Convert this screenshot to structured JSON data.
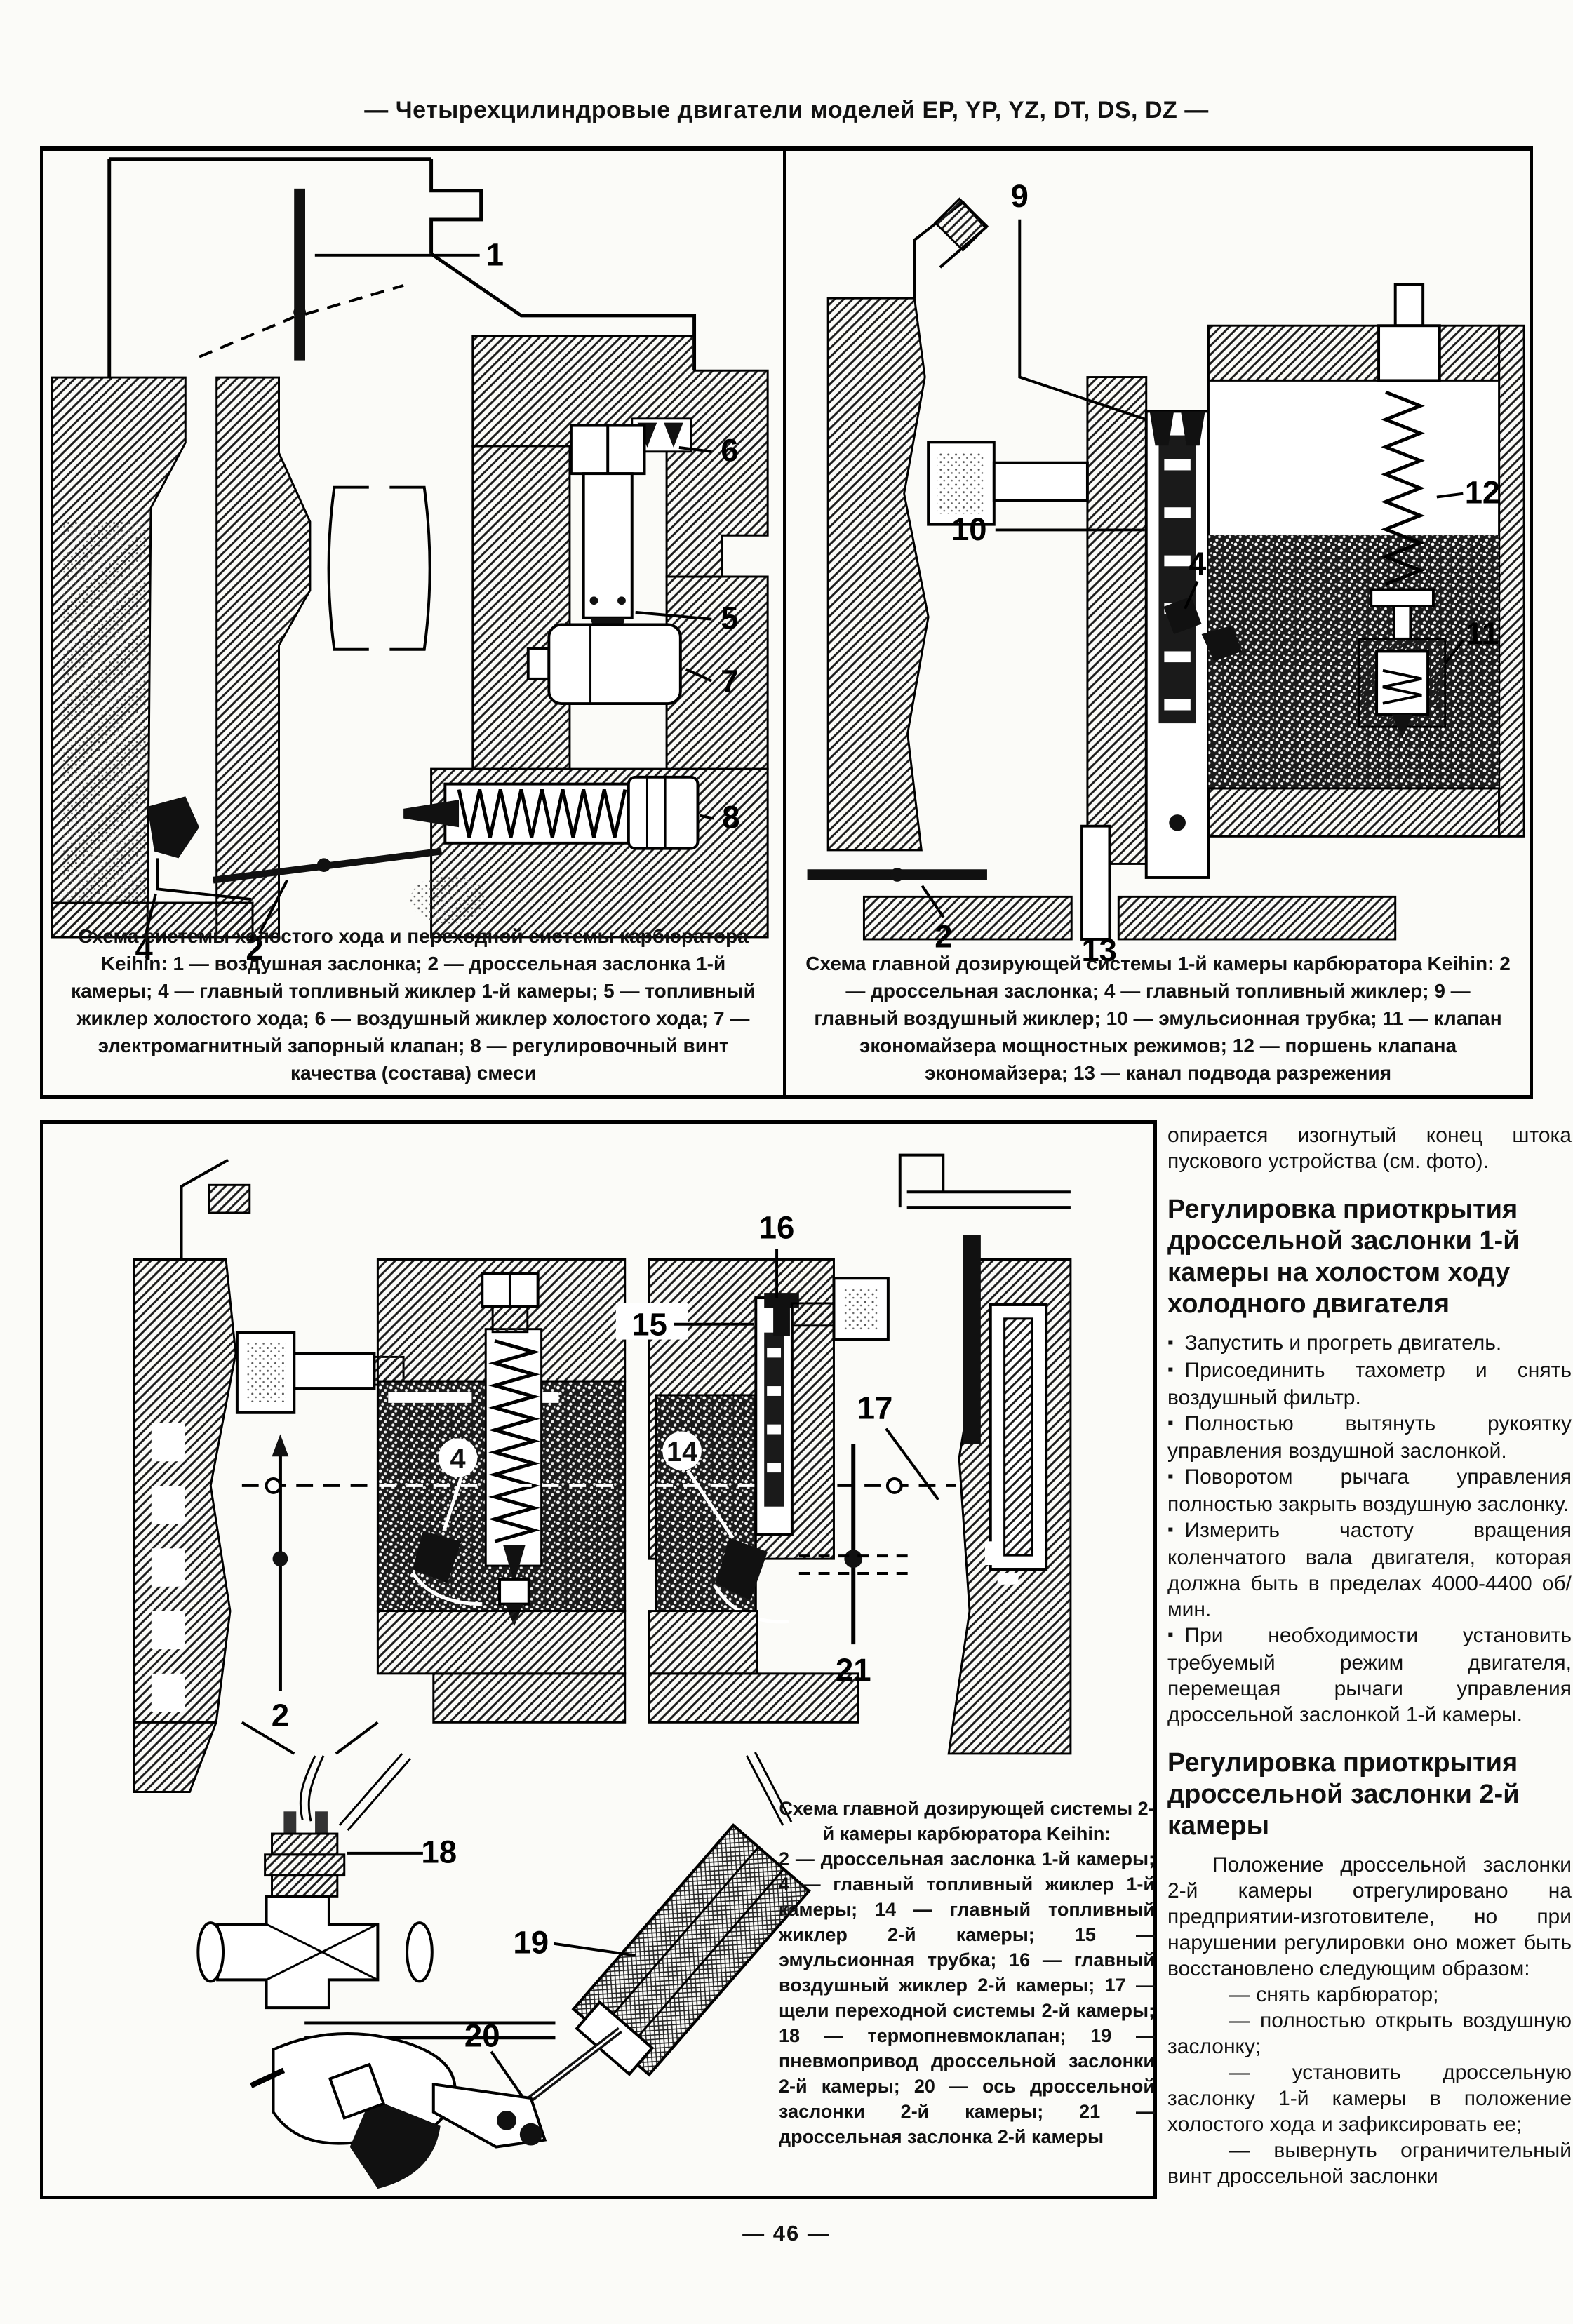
{
  "page": {
    "header": "— Четырехцилиндровые двигатели моделей EP, YP, YZ, DT, DS, DZ —",
    "page_number": "— 46 —"
  },
  "figure1": {
    "caption_title": "Схема системы холостого хода и переходной системы карбюратора Keihin:",
    "caption_items": "1 — воздушная заслонка; 2 — дроссельная заслонка 1-й камеры; 4 — главный топливный жиклер 1-й камеры; 5 — топливный жиклер холостого хода; 6 — воздушный жиклер холостого хода; 7 — электромагнитный запорный клапан; 8 — регулировочный винт качества (состава) смеси",
    "callouts": {
      "c1": "1",
      "c2": "2",
      "c4": "4",
      "c5": "5",
      "c6": "6",
      "c7": "7",
      "c8": "8"
    }
  },
  "figure2": {
    "caption_title": "Схема главной дозирующей системы 1-й камеры карбюратора Keihin:",
    "caption_items": "2 — дроссельная заслонка; 4 — главный топливный жиклер; 9 — главный воздушный жиклер; 10 — эмульсионная трубка; 11 — клапан экономайзера мощностных режимов; 12 — поршень клапана экономайзера; 13 — канал подвода разрежения",
    "callouts": {
      "c2": "2",
      "c4": "4",
      "c9": "9",
      "c10": "10",
      "c11": "11",
      "c12": "12",
      "c13": "13"
    }
  },
  "figure3": {
    "caption_title": "Схема главной дозирующей системы 2-й камеры карбюратора Keihin:",
    "caption_items": "2 — дроссельная заслонка 1-й камеры; 4 — главный топливный жиклер 1-й камеры; 14 — главный топливный жиклер 2-й камеры; 15 — эмульсионная трубка; 16 — главный воздушный жиклер 2-й камеры; 17 — щели переходной системы 2-й камеры; 18 — термопневмоклапан; 19 — пневмопривод дроссельной заслонки 2-й камеры; 20 — ось дроссельной заслонки 2-й камеры; 21 — дроссельная заслонка 2-й камеры",
    "callouts": {
      "c2": "2",
      "c4": "4",
      "c14": "14",
      "c15": "15",
      "c16": "16",
      "c17": "17",
      "c18": "18",
      "c19": "19",
      "c20": "20",
      "c21": "21"
    }
  },
  "column": {
    "intro": "опирается изогнутый конец штока пускового устройства (см. фото).",
    "section1": {
      "heading": "Регулировка приоткрытия дроссельной заслонки 1-й камеры на холостом ходу холодного двигателя",
      "bullets": [
        "Запустить и прогреть двигатель.",
        "Присоединить тахометр и снять воздушный фильтр.",
        "Полностью вытянуть рукоятку управления воздушной заслонкой.",
        "Поворотом рычага управления полностью закрыть воздушную заслонку.",
        "Измерить частоту вращения коленчатого вала двигателя, которая должна быть в пределах 4000-4400 об/мин.",
        "При необходимости установить требуемый режим двигателя, перемещая рычаги управления дроссельной заслонкой 1-й камеры."
      ]
    },
    "section2": {
      "heading": "Регулировка приоткрытия дроссельной заслонки 2-й камеры",
      "intro": "Положение дроссельной заслонки 2-й камеры отрегулировано на предприятии-изготовителе, но при нарушении регулировки оно может быть восстановлено следующим образом:",
      "steps": [
        "— снять карбюратор;",
        "— полностью открыть воздушную заслонку;",
        "— установить дроссельную заслонку 1-й камеры в положение холостого хода и зафиксировать ее;",
        "— вывернуть ограничительный винт дроссельной заслонки"
      ]
    }
  }
}
